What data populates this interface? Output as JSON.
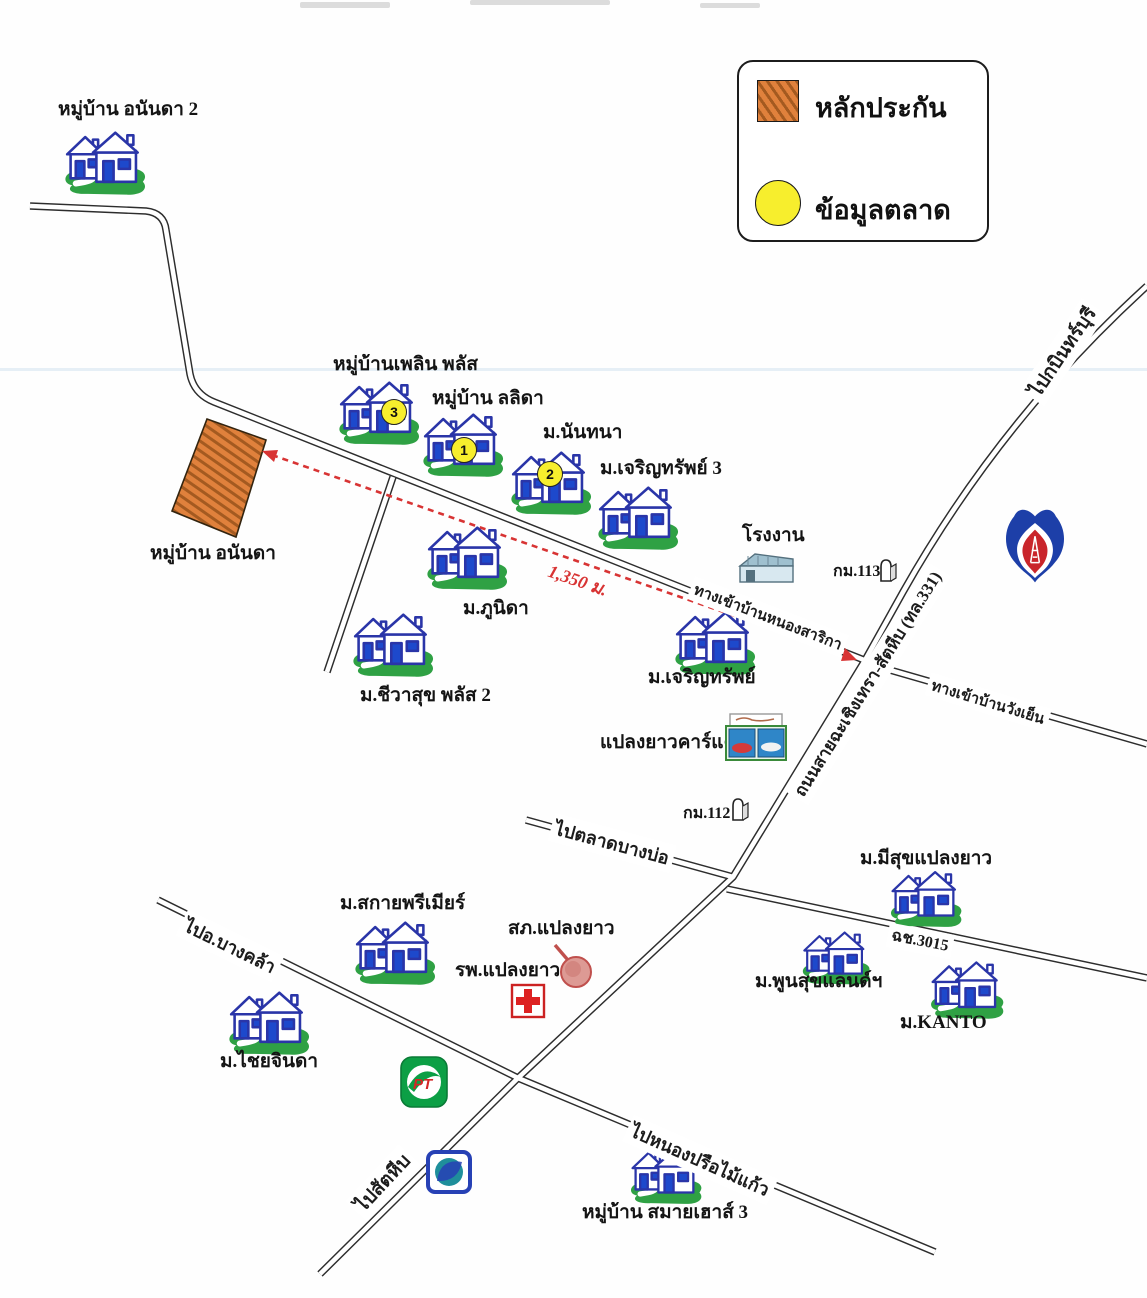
{
  "legend": {
    "collateral_label": "หลักประกัน",
    "market_label": "ข้อมูลตลาด"
  },
  "collateral_plot": {
    "label": "หมู่บ้าน อนันดา"
  },
  "distance_arrow": {
    "label": "1,350 ม."
  },
  "villages": [
    {
      "label": "หมู่บ้าน อนันดา 2"
    },
    {
      "label": "หมู่บ้านเพลิน พลัส",
      "badge": "3"
    },
    {
      "label": "หมู่บ้าน ลลิดา",
      "badge": "1"
    },
    {
      "label": "ม.นันทนา",
      "badge": "2"
    },
    {
      "label": "ม.เจริญทรัพย์ 3"
    },
    {
      "label": "ม.ภูนิดา"
    },
    {
      "label": "ม.ชีวาสุข พลัส 2"
    },
    {
      "label": "ม.เจริญทรัพย์"
    },
    {
      "label": "ม.มีสุขแปลงยาว"
    },
    {
      "label": "ม.สกายพรีเมียร์"
    },
    {
      "label": "ม.พูนสุขแลนด์ฯ"
    },
    {
      "label": "ม.KANTO"
    },
    {
      "label": "ม.ไชยจินดา"
    },
    {
      "label": "หมู่บ้าน สมายเฮาส์ 3"
    }
  ],
  "landmarks": {
    "factory": {
      "label": "โรงงาน"
    },
    "car_care": {
      "label": "แปลงยาวคาร์แคร์"
    },
    "police_station": {
      "label": "สภ.แปลงยาว"
    },
    "hospital": {
      "label": "รพ.แปลงยาว"
    },
    "km_113": {
      "label": "กม.113"
    },
    "km_112": {
      "label": "กม.112"
    },
    "pt_logo": {
      "text": "PT"
    }
  },
  "roads": {
    "to_kabin_buri": "ไปกบินทร์บุรี",
    "main_highway": "ถนนสายฉะเชิงเทรา-สัตหีบ (ทล.331)",
    "nong_sarika_entrance": "ทางเข้าบ้านหนองสาริกา",
    "wang_yen_entrance": "ทางเข้าบ้านวังเย็น",
    "to_bang_bo_market": "ไปตลาดบางบ่อ",
    "route_3015": "ฉช.3015",
    "to_bang_khla": "ไปอ.บางคล้า",
    "to_sattahip": "ไปสัตหีบ",
    "to_nong_prue_mai_kaeo": "ไปหนองปรือไม้แก้ว"
  },
  "colors": {
    "collateral_orange": "#e0813c",
    "market_yellow": "#f7ee2d",
    "arrow_red": "#d83434",
    "house_blue": "#2a35a8",
    "lawn_green": "#2fa144",
    "road_black": "#2d2d2d"
  }
}
